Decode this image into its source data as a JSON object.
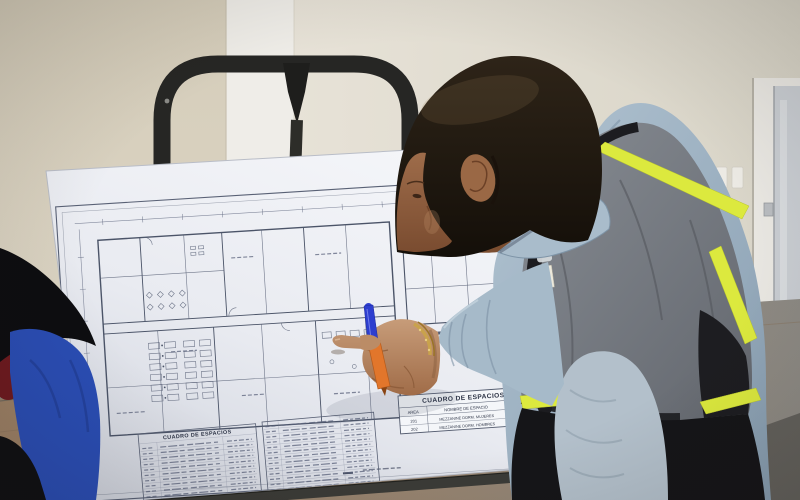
{
  "blueprint": {
    "space_table": {
      "title": "CUADRO DE ESPACIOS",
      "columns": [
        "AREA",
        "NOMBRE DE ESPACIO",
        "M2"
      ],
      "rows": [
        {
          "area": "201",
          "name": "MEZZANINE DORM. MUJERES",
          "m2": "44.65"
        },
        {
          "area": "202",
          "name": "MEZZANINE DORM. HOMBRES",
          "m2": "77.35"
        }
      ]
    },
    "legend_table": {
      "title": "CUADRO DE ESPACIOS"
    }
  },
  "colors": {
    "wall": "#d9d2c2",
    "paper": "#eef0f5",
    "plan_line": "#4b5468",
    "easel_frame": "#262624",
    "vest_hiviz": "#dce93e",
    "vest_gray": "#7a7f86",
    "shirt_blue": "#9fb3c4",
    "skin": "#b98a64",
    "pen_cap_blue": "#2d3ecf",
    "pen_orange": "#e2762b",
    "bracelet_gold": "#c9a24c",
    "door_glass": "#c9cdd2",
    "floor_wood": "#9a8066",
    "bystander_blue": "#2a4db4"
  }
}
